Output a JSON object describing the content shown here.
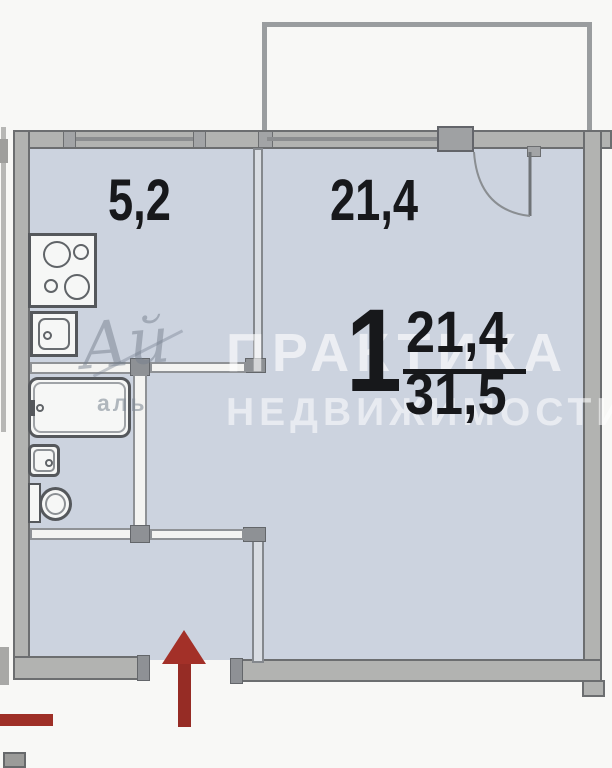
{
  "floor_plan": {
    "apartment": {
      "rooms_count": "1",
      "living_area": "21,4",
      "total_area": "31,5"
    },
    "rooms": [
      {
        "id": "kitchen",
        "area_label": "5,2"
      },
      {
        "id": "living-room",
        "area_label": "21,4"
      }
    ],
    "fixtures": [
      "stove",
      "kitchen-sink",
      "bathtub",
      "washbasin",
      "toilet"
    ],
    "entrance_marker": "red-arrow",
    "watermark": {
      "logo": "Ай",
      "logo_caption": "аль",
      "line1": "ПРАКТИКА",
      "line2": "НЕДВИЖИМОСТИ"
    },
    "colors": {
      "room_fill": "#ccd3df",
      "wall_gray": "#b2b3b1",
      "wall_edge": "#6c6e70",
      "entrance_red": "#9e2f27",
      "label_text": "#17181b",
      "watermark_text": "rgba(255,255,255,0.6)"
    }
  }
}
